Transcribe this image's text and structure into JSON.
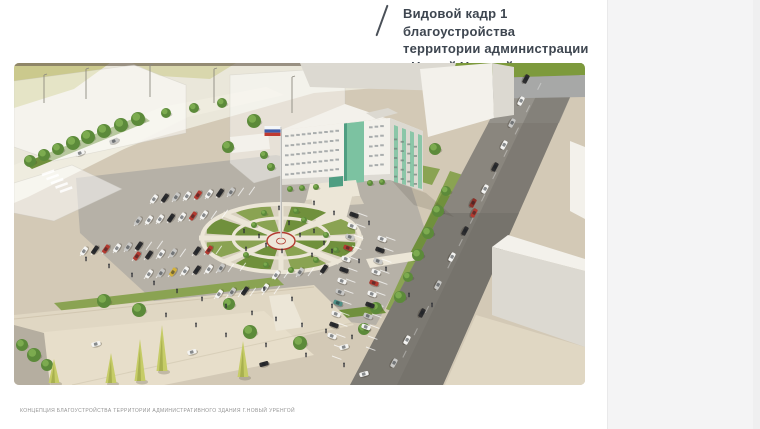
{
  "viewer": {
    "page_background": "#ffffff",
    "panel_color": "#f4f4f5"
  },
  "header": {
    "slash_icon": "/",
    "title_lines": [
      "Видовой кадр 1 благоустройства",
      "территории администрации",
      "г.Новый Уренгой"
    ],
    "title_color": "#3e4650"
  },
  "footer": {
    "caption": "КОНЦЕПЦИЯ БЛАГОУСТРОЙСТВА ТЕРРИТОРИИ АДМИНИСТРАТИВНОГО ЗДАНИЯ Г.НОВЫЙ УРЕНГОЙ"
  },
  "scene": {
    "palette": {
      "ground": "#d3c9b6",
      "groundLight": "#e0d7c3",
      "ground2": "#e7deca",
      "pale": "#eae7da",
      "roadPale2": "#efecdf",
      "asphalt": "#b6b1a7",
      "plaza": "#d9d2c0",
      "path": "#ece6d7",
      "roadDark": "#6e6c66",
      "roadMid": "#8a867e",
      "roadLight": "#97958f",
      "lawn": "#8aa352",
      "lawnDark": "#70903c",
      "lawnPale": "#cbc98d",
      "lawnPale2": "#d9d7ad",
      "stripGreen": "#7d9a3c",
      "grayBand": "#a7a8a7",
      "white": "#f3f1eb",
      "whiteShade": "#dcd9d1",
      "glass": "#7cc2a1",
      "glassDark": "#4f9e82",
      "ring": "#b23b30",
      "flagBlue": "#3d5aa8",
      "flagRed": "#bf3a30",
      "treeDark": "#5c8a3a",
      "treeLight": "#7fae52",
      "conifer": "#c6cc67",
      "wall": "#b5aea0",
      "person": "#2e3036"
    },
    "car_colors": {
      "w": "#f4f4f2",
      "s": "#c8c8c6",
      "g": "#8f8f8d",
      "k": "#2d2d2f",
      "r": "#b23a30",
      "d": "#8c2f27",
      "y": "#d2b13c",
      "b": "#41609b",
      "t": "#4f8f86"
    },
    "cars_parked": [
      [
        140,
        136,
        -55,
        "w"
      ],
      [
        151,
        135,
        -55,
        "k"
      ],
      [
        162,
        134,
        -55,
        "s"
      ],
      [
        173,
        133,
        -55,
        "w"
      ],
      [
        184,
        132,
        -55,
        "r"
      ],
      [
        195,
        131,
        -55,
        "w"
      ],
      [
        206,
        130,
        -55,
        "k"
      ],
      [
        217,
        129,
        -55,
        "s"
      ],
      [
        124,
        158,
        -55,
        "s"
      ],
      [
        135,
        157,
        -55,
        "w"
      ],
      [
        146,
        156,
        -55,
        "w"
      ],
      [
        157,
        155,
        -55,
        "k"
      ],
      [
        168,
        154,
        -55,
        "w"
      ],
      [
        179,
        153,
        -55,
        "r"
      ],
      [
        190,
        152,
        -55,
        "w"
      ],
      [
        70,
        188,
        -55,
        "w"
      ],
      [
        81,
        187,
        -55,
        "k"
      ],
      [
        92,
        186,
        -55,
        "r"
      ],
      [
        103,
        185,
        -55,
        "w"
      ],
      [
        114,
        184,
        -55,
        "s"
      ],
      [
        125,
        183,
        -55,
        "k"
      ],
      [
        123,
        193,
        -55,
        "r"
      ],
      [
        135,
        192,
        -55,
        "k"
      ],
      [
        147,
        191,
        -55,
        "w"
      ],
      [
        159,
        190,
        -55,
        "s"
      ],
      [
        183,
        188,
        -55,
        "k"
      ],
      [
        195,
        187,
        -55,
        "r"
      ],
      [
        135,
        211,
        -55,
        "w"
      ],
      [
        147,
        210,
        -55,
        "s"
      ],
      [
        159,
        209,
        -55,
        "y"
      ],
      [
        171,
        208,
        -55,
        "w"
      ],
      [
        183,
        207,
        -55,
        "k"
      ],
      [
        195,
        206,
        -55,
        "w"
      ],
      [
        207,
        205,
        -55,
        "s"
      ],
      [
        205,
        231,
        -55,
        "w"
      ],
      [
        218,
        229,
        -55,
        "s"
      ],
      [
        231,
        228,
        -55,
        "k"
      ],
      [
        251,
        225,
        -55,
        "w"
      ],
      [
        262,
        212,
        -55,
        "w"
      ],
      [
        286,
        209,
        -55,
        "s"
      ],
      [
        310,
        206,
        -55,
        "k"
      ],
      [
        340,
        152,
        20,
        "k"
      ],
      [
        338,
        163,
        20,
        "w"
      ],
      [
        336,
        174,
        20,
        "s"
      ],
      [
        334,
        185,
        20,
        "r"
      ],
      [
        332,
        196,
        20,
        "w"
      ],
      [
        330,
        207,
        20,
        "k"
      ],
      [
        328,
        218,
        20,
        "w"
      ],
      [
        326,
        229,
        20,
        "s"
      ],
      [
        324,
        240,
        20,
        "t"
      ],
      [
        322,
        251,
        20,
        "w"
      ],
      [
        320,
        262,
        20,
        "k"
      ],
      [
        318,
        273,
        20,
        "w"
      ],
      [
        368,
        176,
        20,
        "w"
      ],
      [
        366,
        187,
        20,
        "k"
      ],
      [
        364,
        198,
        20,
        "s"
      ],
      [
        362,
        209,
        20,
        "w"
      ],
      [
        360,
        220,
        20,
        "r"
      ],
      [
        358,
        231,
        20,
        "w"
      ],
      [
        356,
        242,
        20,
        "k"
      ],
      [
        354,
        253,
        20,
        "s"
      ],
      [
        352,
        264,
        20,
        "w"
      ]
    ],
    "cars_road": [
      [
        512,
        16,
        118,
        "k"
      ],
      [
        507,
        38,
        118,
        "w"
      ],
      [
        498,
        60,
        118,
        "s"
      ],
      [
        490,
        82,
        118,
        "w"
      ],
      [
        481,
        104,
        118,
        "k"
      ],
      [
        471,
        126,
        118,
        "w"
      ],
      [
        460,
        150,
        118,
        "r"
      ],
      [
        451,
        168,
        118,
        "k"
      ],
      [
        438,
        194,
        118,
        "w"
      ],
      [
        424,
        222,
        118,
        "s"
      ],
      [
        408,
        250,
        118,
        "k"
      ],
      [
        393,
        277,
        118,
        "w"
      ],
      [
        380,
        300,
        118,
        "s"
      ],
      [
        459,
        140,
        118,
        "d"
      ],
      [
        82,
        281,
        -15,
        "w"
      ],
      [
        178,
        289,
        -15,
        "w"
      ],
      [
        330,
        284,
        -15,
        "w"
      ],
      [
        350,
        311,
        -15,
        "w"
      ],
      [
        250,
        301,
        -15,
        "k"
      ],
      [
        66,
        90,
        -22,
        "w"
      ],
      [
        100,
        78,
        -22,
        "s"
      ]
    ],
    "trees": [
      [
        16,
        98,
        6
      ],
      [
        30,
        92,
        6
      ],
      [
        44,
        86,
        6
      ],
      [
        59,
        80,
        7
      ],
      [
        74,
        74,
        7
      ],
      [
        90,
        68,
        7
      ],
      [
        107,
        62,
        7
      ],
      [
        124,
        56,
        7
      ],
      [
        152,
        50,
        5
      ],
      [
        180,
        45,
        5
      ],
      [
        208,
        40,
        5
      ],
      [
        240,
        58,
        7
      ],
      [
        214,
        84,
        6
      ],
      [
        250,
        92,
        4
      ],
      [
        257,
        104,
        4
      ],
      [
        421,
        86,
        6
      ],
      [
        432,
        128,
        5
      ],
      [
        424,
        148,
        6
      ],
      [
        414,
        170,
        6
      ],
      [
        404,
        192,
        6
      ],
      [
        394,
        214,
        5
      ],
      [
        386,
        234,
        6
      ],
      [
        90,
        238,
        7
      ],
      [
        125,
        247,
        7
      ],
      [
        215,
        241,
        6
      ],
      [
        236,
        269,
        7
      ],
      [
        286,
        280,
        7
      ],
      [
        362,
        245,
        6
      ],
      [
        350,
        266,
        6
      ],
      [
        8,
        282,
        6
      ],
      [
        20,
        292,
        7
      ],
      [
        33,
        302,
        6
      ],
      [
        240,
        162,
        3
      ],
      [
        290,
        157,
        3
      ],
      [
        312,
        172,
        3
      ],
      [
        232,
        192,
        3
      ],
      [
        252,
        202,
        3
      ],
      [
        302,
        197,
        3
      ],
      [
        322,
        187,
        3
      ],
      [
        277,
        207,
        3
      ],
      [
        250,
        150,
        3
      ],
      [
        282,
        148,
        3
      ],
      [
        276,
        126,
        3
      ],
      [
        288,
        125,
        3
      ],
      [
        302,
        124,
        3
      ],
      [
        356,
        120,
        3
      ],
      [
        368,
        119,
        3
      ]
    ],
    "conifers": [
      [
        126,
        318,
        42
      ],
      [
        148,
        308,
        46
      ],
      [
        97,
        320,
        30
      ],
      [
        229,
        314,
        36
      ],
      [
        40,
        320,
        24
      ]
    ],
    "people": [
      [
        118,
        214
      ],
      [
        140,
        222
      ],
      [
        163,
        230
      ],
      [
        188,
        238
      ],
      [
        212,
        245
      ],
      [
        238,
        252
      ],
      [
        262,
        258
      ],
      [
        288,
        264
      ],
      [
        312,
        270
      ],
      [
        338,
        276
      ],
      [
        95,
        205
      ],
      [
        72,
        198
      ],
      [
        250,
        228
      ],
      [
        278,
        238
      ],
      [
        318,
        245
      ],
      [
        395,
        234
      ],
      [
        418,
        244
      ],
      [
        232,
        188
      ],
      [
        252,
        184
      ],
      [
        268,
        190
      ],
      [
        298,
        194
      ],
      [
        318,
        190
      ],
      [
        345,
        200
      ],
      [
        372,
        208
      ],
      [
        152,
        254
      ],
      [
        182,
        264
      ],
      [
        212,
        274
      ],
      [
        252,
        284
      ],
      [
        292,
        294
      ],
      [
        330,
        304
      ],
      [
        275,
        162
      ],
      [
        286,
        174
      ],
      [
        300,
        170
      ],
      [
        310,
        182
      ],
      [
        265,
        147
      ],
      [
        300,
        142
      ],
      [
        320,
        152
      ],
      [
        355,
        162
      ],
      [
        230,
        170
      ],
      [
        245,
        175
      ]
    ],
    "poles": [
      [
        30,
        12,
        28
      ],
      [
        72,
        6,
        30
      ],
      [
        136,
        2,
        32
      ],
      [
        200,
        6,
        34
      ],
      [
        278,
        14,
        36
      ]
    ],
    "parking_rows": [
      [
        136,
        141,
        11,
        -1,
        9,
        -55
      ],
      [
        120,
        163,
        11,
        -1,
        8,
        -55
      ],
      [
        66,
        193,
        11,
        -1,
        7,
        -55
      ],
      [
        118,
        198,
        12,
        -1,
        7,
        -55
      ],
      [
        130,
        216,
        12,
        -1,
        8,
        -55
      ],
      [
        200,
        236,
        12,
        -1,
        5,
        -55
      ],
      [
        258,
        216,
        12,
        -1,
        4,
        -55
      ],
      [
        344,
        150,
        -2,
        11,
        13,
        20
      ],
      [
        372,
        174,
        -2,
        11,
        10,
        20
      ]
    ]
  }
}
